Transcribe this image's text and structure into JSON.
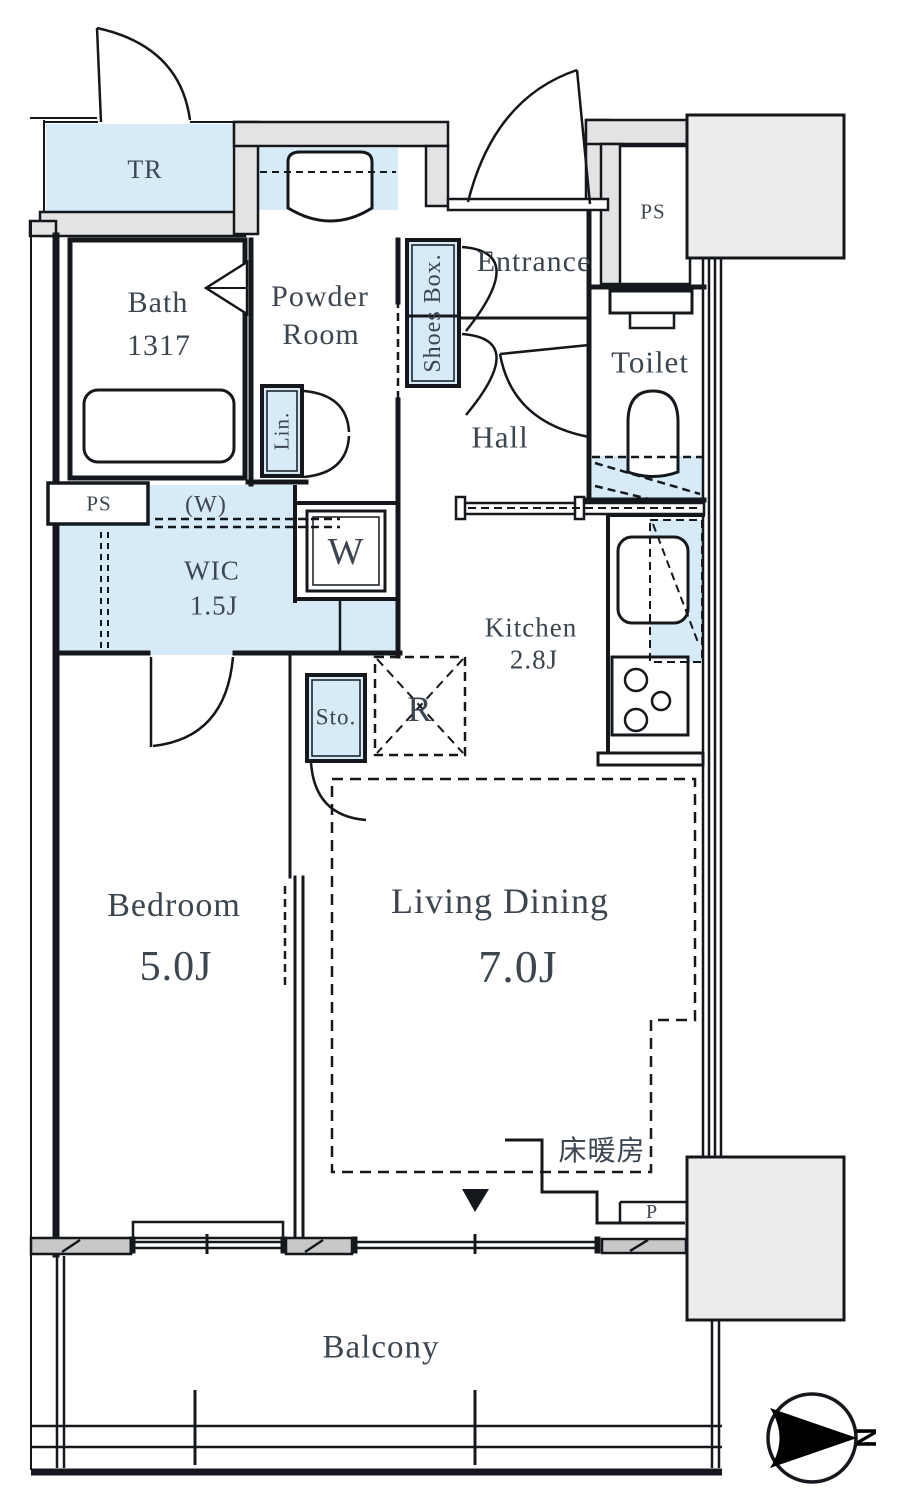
{
  "colors": {
    "room_fill": "#d7eaf8",
    "wall_gray": "#e3e3e3",
    "block_gray": "#ececec",
    "slab_gray": "#c8c8c8",
    "line": "#14181c",
    "text": "#3c4650"
  },
  "labels": {
    "tr": "TR",
    "bath_1": "Bath",
    "bath_2": "1317",
    "powder_1": "Powder",
    "powder_2": "Room",
    "shoes_box": "Shoes Box.",
    "entrance": "Entrance",
    "ps_top": "PS",
    "toilet": "Toilet",
    "hall": "Hall",
    "linen": "Lin.",
    "ps_left": "PS",
    "washer_hookup": "(W)",
    "wic_1": "WIC",
    "wic_2": "1.5J",
    "washer": "W",
    "kitchen_1": "Kitchen",
    "kitchen_2": "2.8J",
    "storage": "Sto.",
    "refrigerator": "R",
    "bedroom_1": "Bedroom",
    "bedroom_2": "5.0J",
    "living_1": "Living Dining",
    "living_2": "7.0J",
    "floor_heating": "床暖房",
    "pipe_space": "P",
    "balcony": "Balcony",
    "compass_north": "N"
  }
}
